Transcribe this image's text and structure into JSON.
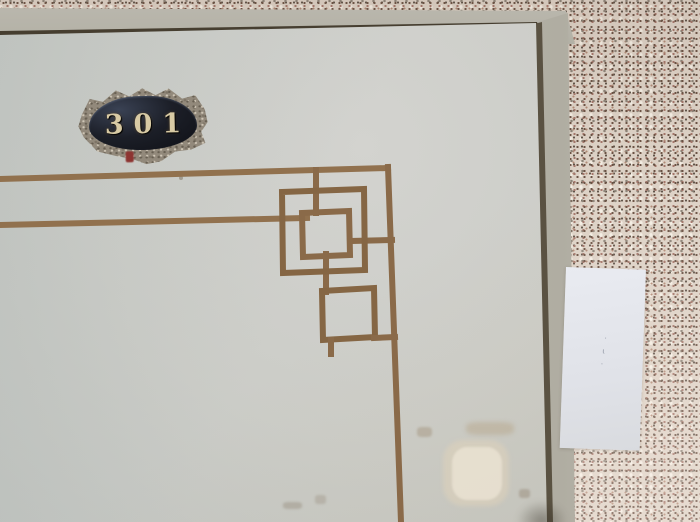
{
  "door": {
    "number": "301",
    "plate": {
      "digit_color": "#d8caa4",
      "glass_color": "#1c1f28",
      "frame_color": "#92897b",
      "accent_color": "#8d3431"
    },
    "trim_color": "#8a6a49",
    "panel_color": "#cccdc8"
  },
  "frame": {
    "jamb_color": "#b3b1a6",
    "gap_color": "#5a5242",
    "header_line_color": "#463e30"
  },
  "wall": {
    "base_color": "#ddd2c6",
    "speckle_colors": [
      "#6b5244",
      "#a3766a",
      "#8d8478",
      "#b08a76",
      "#f4eee4"
    ]
  },
  "paper": {
    "color": "#e4e7ee",
    "marks": [
      "·",
      "ι",
      "·"
    ]
  }
}
